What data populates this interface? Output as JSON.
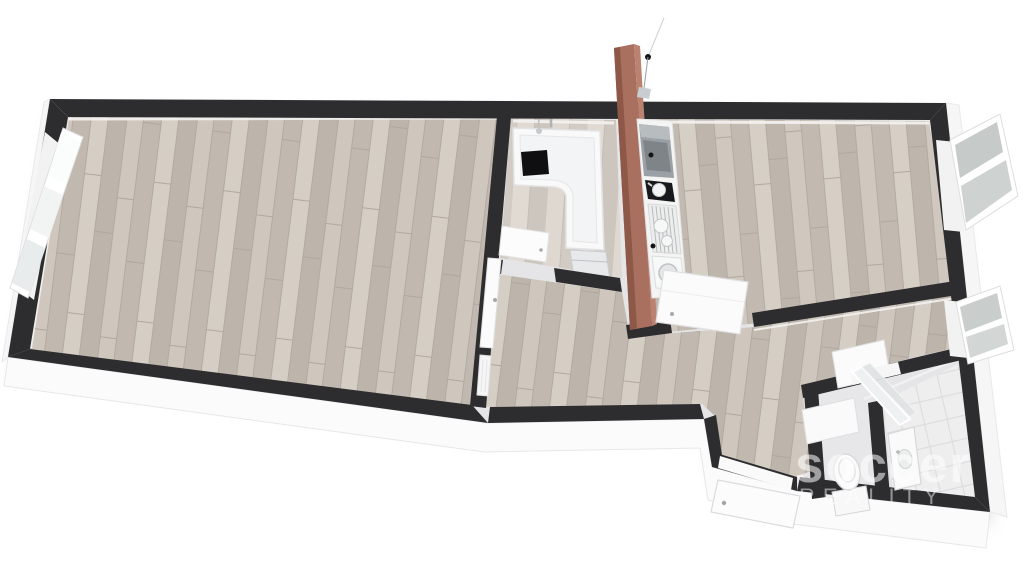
{
  "meta": {
    "kind": "3d-rendered-floor-plan",
    "view": "top-down axonometric",
    "background": "#ffffff"
  },
  "watermark": {
    "line1": "soccer",
    "line2": "REALITY",
    "color": "#ffffff"
  },
  "palette": {
    "wall_top": "#2d2d30",
    "wall_side": "#fafafa",
    "wood_floor": "#c8c0b7",
    "wood_floor_light": "#d8d2cb",
    "tile_floor": "#eeeeef",
    "wc_floor": "#e7e7e9",
    "feature_wall_brown": "#a9705f",
    "appliance_grey": "#9aa0a5",
    "cooktop_black": "#17181b",
    "fixture_white": "#fbfbfb",
    "glass_grey": "#c6cac8"
  },
  "rooms": [
    {
      "name": "living-room-left",
      "floor": "wood",
      "fixtures": [
        "window-left",
        "interior-door-closed"
      ]
    },
    {
      "name": "bathroom-top",
      "floor": "wood-light",
      "fixtures": [
        "bathtub",
        "shower-set",
        "towel-bar",
        "black-bath-tray",
        "washing-machine",
        "open-door"
      ]
    },
    {
      "name": "kitchenette-strip",
      "floor": "counter-white",
      "fixtures": [
        "tall-cabinet",
        "cooktop",
        "pot",
        "dish-rack",
        "round-sink",
        "pendant-lamp"
      ]
    },
    {
      "name": "living-room-right",
      "floor": "wood",
      "fixtures": [
        "window-right-upper",
        "open-door"
      ]
    },
    {
      "name": "hallway",
      "floor": "wood",
      "fixtures": [
        "radiator"
      ]
    },
    {
      "name": "corridor",
      "floor": "wood",
      "fixtures": [
        "window-right-lower",
        "open-door"
      ]
    },
    {
      "name": "entrance-vestibule",
      "floor": "wood",
      "fixtures": [
        "entry-door-open"
      ]
    },
    {
      "name": "wc",
      "floor": "tile-grey",
      "fixtures": [
        "toilet",
        "open-door"
      ]
    },
    {
      "name": "bathroom-bottom-right",
      "floor": "tile-white",
      "fixtures": [
        "vanity-sink",
        "glass-shower-door"
      ]
    }
  ],
  "counts": {
    "windows": 3,
    "door-leaves": 7
  }
}
